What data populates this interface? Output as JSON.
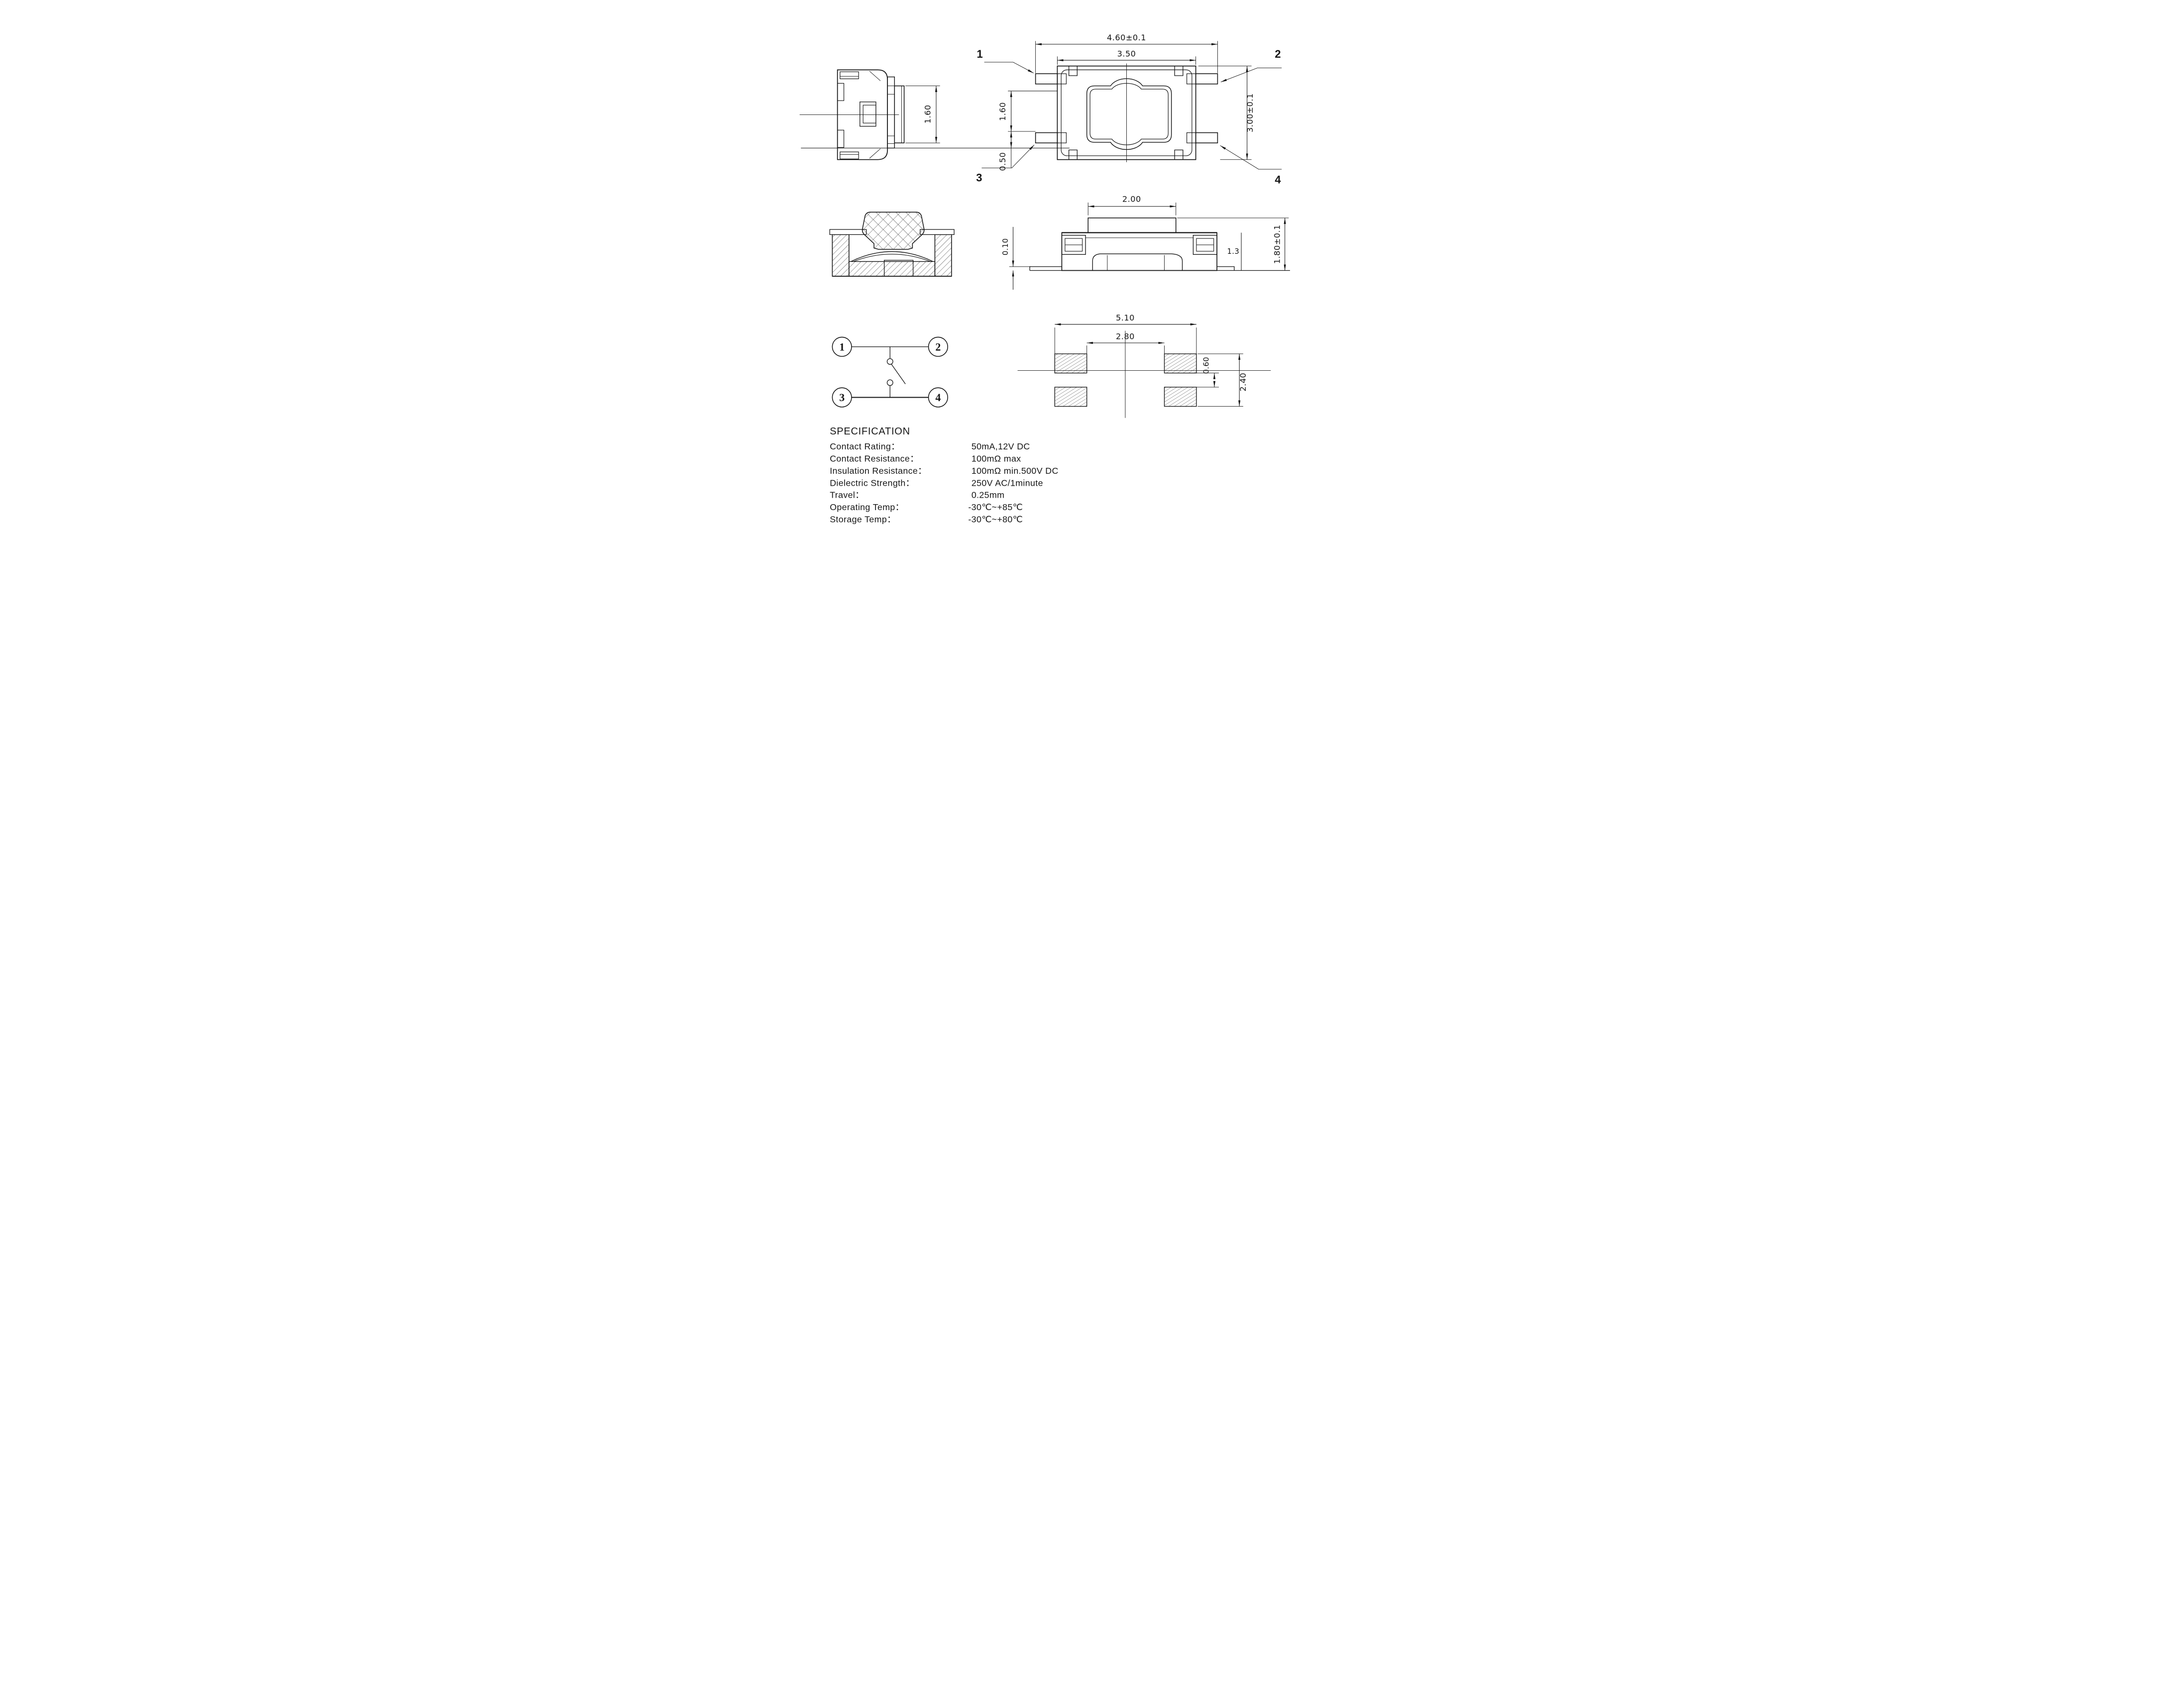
{
  "drawing": {
    "top_view": {
      "pin1": "1",
      "pin2": "2",
      "pin3": "3",
      "pin4": "4",
      "dim_outer_width": "4.60±0.1",
      "dim_inner_width": "3.50",
      "dim_height": "3.00±0.1",
      "dim_pad_height": "1.60",
      "dim_pad_offset": "0.50"
    },
    "side_view": {
      "dim_button_height": "1.60"
    },
    "front_view": {
      "dim_button_width": "2.00",
      "dim_lead_thickness": "0.10",
      "dim_body_height": "1.3",
      "dim_total_height": "1.80±0.1"
    },
    "schematic": {
      "pin1": "1",
      "pin2": "2",
      "pin3": "3",
      "pin4": "4"
    },
    "land_pattern": {
      "dim_overall_width": "5.10",
      "dim_inner_span": "2.80",
      "dim_pad_gap": "0.60",
      "dim_overall_height": "2.40"
    },
    "specification": {
      "title": "SPECIFICATION",
      "rows": [
        {
          "label": "Contact  Rating：",
          "value": "50mA,12V DC"
        },
        {
          "label": "Contact  Resistance：",
          "value": "100mΩ max"
        },
        {
          "label": "Insulation Resistance：",
          "value": "100mΩ min.500V DC"
        },
        {
          "label": "Dielectric  Strength：",
          "value": "250V AC/1minute"
        },
        {
          "label": "Travel：",
          "value": "0.25mm"
        },
        {
          "label": "Operating Temp：",
          "value": "-30℃~+85℃"
        },
        {
          "label": "Storage Temp：",
          "value": "-30℃~+80℃"
        }
      ]
    }
  }
}
